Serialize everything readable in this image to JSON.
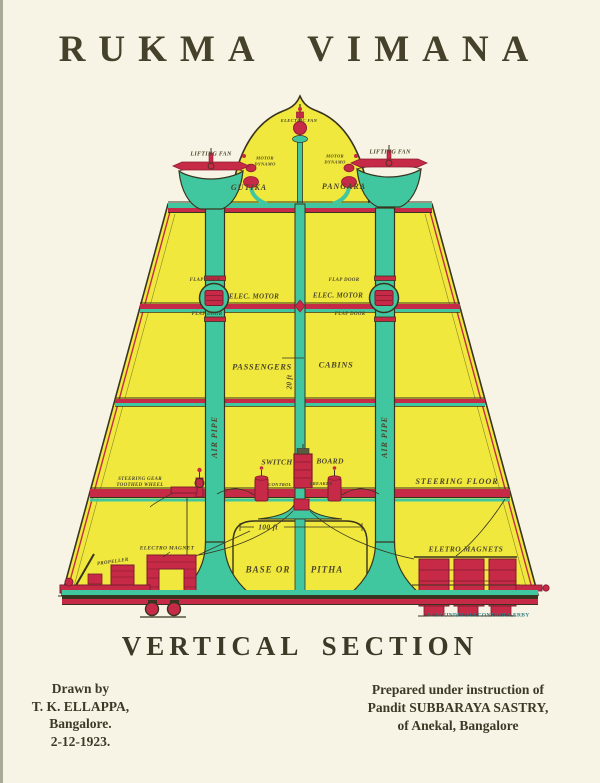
{
  "title": "RUKMA VIMANA",
  "caption": "VERTICAL SECTION",
  "credits": {
    "left": [
      "Drawn by",
      "T. K. ELLAPPA,",
      "Bangalore.",
      "2-12-1923."
    ],
    "right": [
      "Prepared under instruction of",
      "Pandit SUBBARAYA SASTRY,",
      "of Anekal, Bangalore"
    ]
  },
  "diagram_labels": {
    "electric_fan": "ELECTRIC FAN",
    "lifting_fan_left": "LIFTING FAN",
    "lifting_fan_right": "LIFTING FAN",
    "motor_dynamo_left": "MOTOR\nDYNAMO",
    "motor_dynamo_right": "MOTOR\nDYNAMO",
    "gutika": "GUTIKA",
    "pangara": "PANGARA",
    "flap_door_tl": "FLAP DOOR",
    "flap_door_tr": "FLAP DOOR",
    "flap_door_bl": "FLAP DOOR",
    "flap_door_br": "FLAP DOOR",
    "elec_motor_left": "ELEC. MOTOR",
    "elec_motor_right": "ELEC. MOTOR",
    "passengers": "PASSENGERS",
    "cabins": "CABINS",
    "twenty_ft": "20 ft",
    "air_pipe_left": "AIR PIPE",
    "air_pipe_right": "AIR PIPE",
    "switch": "SWITCH",
    "board": "BOARD",
    "control": "CONTROL",
    "breaker": "BREAKER",
    "steering_gear": "STEERING GEAR\nTOOTHED WHEEL",
    "steering_floor": "STEERING FLOOR",
    "hundred_ft": "100 ft",
    "electro_magnet": "ELECTRO MAGNET",
    "propeller": "PROPELLER",
    "base_or": "BASE OR",
    "pitha": "PITHA",
    "eletro_magnets": "ELETRO MAGNETS",
    "illegible_caption": "ALAFFINDELAIA CONTROLS-ERBY"
  },
  "colors": {
    "page": "#f7f4e6",
    "body_yellow": "#f0e83c",
    "pipe_teal": "#41c79f",
    "machine_red": "#c62a46",
    "ink": "#39341f",
    "label_ink": "#4b452a",
    "caption_teal": "#2f7b82"
  }
}
